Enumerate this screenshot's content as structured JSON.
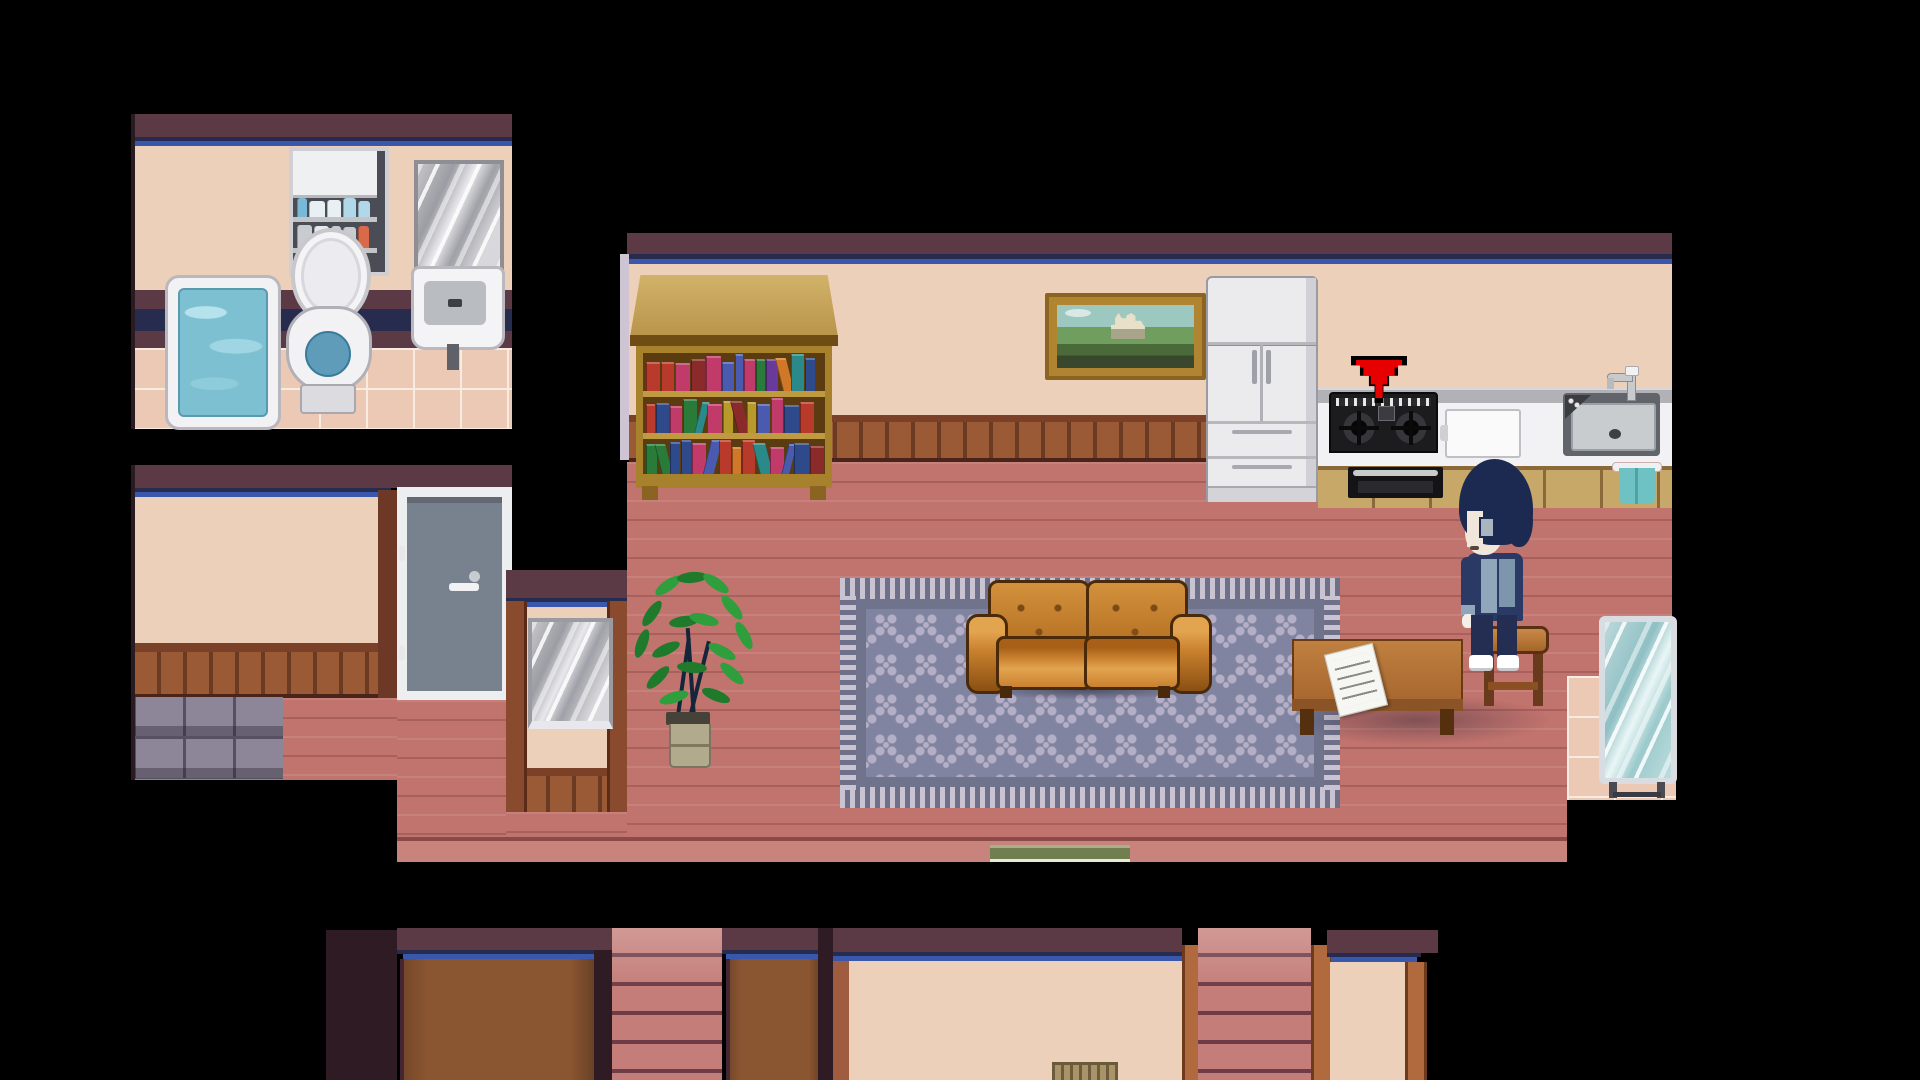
{
  "scene": {
    "title": "Top-down pixel RPG house interior (OMORI-style)",
    "screen": {
      "width": 1920,
      "height": 1080
    },
    "visible_text": []
  },
  "palette": {
    "band": "#5b3a46",
    "darkMaroon": "#2e1b24",
    "stripeNavy": "#272b4e",
    "stripeBlue": "#3a57ae",
    "trimLight": "#cfc4d4",
    "wall": "#ecd0ba",
    "wainscot": "#9a5a36",
    "wainscotGap": "#6b3a22",
    "wainscotRail": "#7a4028",
    "wainscotLine": "#4a2418",
    "floor": "#c1736d",
    "floorEdge": "#c8837c",
    "floorEdgeLine": "#8a4a48",
    "tileFloor": "#ecc9b5",
    "tileGrout": "#f8ece2",
    "grayTile": "#8d8698",
    "grayTileGrout": "#575061",
    "rugField": "#8184a0",
    "rugMotif": "#b4aec6",
    "rugBorder": "#70738c",
    "fringeLight": "#cac4d2",
    "fringeDark": "#6e7089",
    "couch": "#c9812f",
    "couchDark": "#8a5012",
    "couchLight": "#e3a44f",
    "couchOutline": "#4a2a08",
    "wood": "#c6a45e",
    "woodFrame": "#a8812c",
    "shelfBg": "#5a3c10",
    "applianceWhite": "#ebebed",
    "applianceShade": "#d0d0d6",
    "applianceOutline": "#9a9aa2",
    "counterTop": "#b2b2b6",
    "counterFront": "#f2f2f4",
    "cabinetTan": "#c8a869",
    "cabinetLine": "#8a6a3a",
    "stoveBlack": "#1c1c1e",
    "sinkSurround": "#62646c",
    "sinkBasin": "#c9ccce",
    "towel": "#6fc2c4",
    "arrowRed": "#e60000",
    "doorSlab": "#78818e",
    "doorFrame": "#eceef0",
    "waterBlue": "#7cc0d2",
    "toiletWater": "#5f9cba",
    "plantGreen": "#2f9e3c",
    "plantGreenDark": "#1f7a2c",
    "stem": "#16263a",
    "pot": "#b2aa8c",
    "hairNavy": "#1c2a52",
    "skin": "#f0e6da",
    "outfitNavy": "#2b3a64",
    "outfitLight": "#90a6ba",
    "pantsNavy": "#232e52",
    "mirrorGlass": "#a9cfd3",
    "mirrorFrame": "#d9dde2",
    "stairs": "#c47d78",
    "stairsLine": "#6e3c46",
    "panelBrown": "#8a5531",
    "panelEdge": "#432633",
    "postOrange": "#b06a3e",
    "matGreen": "#707e50",
    "matGreenLight": "#a8b088"
  },
  "rooms": {
    "bathroom": {
      "label": "bathroom",
      "fixtures": [
        "bathtub with water",
        "toilet with open lid",
        "medicine cabinet with bottles",
        "wall mirror",
        "wall sink"
      ]
    },
    "side_room": {
      "label": "side room",
      "fixtures": [
        "blank beige wall panel",
        "gray entry door with handle",
        "gray floor tiles"
      ]
    },
    "living_room": {
      "label": "living room and kitchen",
      "fixtures": [
        "bookshelf",
        "landscape painting",
        "refrigerator",
        "gas stove",
        "oven grill",
        "cutting board",
        "kitchen sink",
        "teal hand towel",
        "patterned rug",
        "leather couch",
        "coffee table",
        "paper note",
        "wooden stool",
        "potted plant",
        "standing mirror",
        "alcove mirror",
        "green doormat",
        "pink tile corner"
      ]
    },
    "lower_rooms": {
      "label": "lower floor rooms",
      "fixtures": [
        "brown panel wall",
        "staircase",
        "brown panel wall",
        "beige room",
        "staircase",
        "beige room"
      ]
    }
  },
  "indicator": {
    "name": "quest-arrow",
    "meaning": "interaction point above the stove",
    "color": "#e60000"
  },
  "character": {
    "name": "player-character",
    "description": "dark navy-haired boy in blue outfit standing by the coffee table",
    "hair_color": "#1c2a52",
    "outfit_colors": [
      "#2b3a64",
      "#90a6ba"
    ],
    "shoes": "white"
  },
  "objects": {
    "bookshelf": {
      "book_colors": [
        "#2e4a8a",
        "#b83a2a",
        "#6a3a9a",
        "#2a7a3a",
        "#d07828",
        "#c03a6a",
        "#2a8a8a",
        "#b89a2a",
        "#4a5aae",
        "#8a2a2a"
      ]
    },
    "cabinet": {
      "item_colors_top": [
        "#7ab8d8",
        "#e8f0f4",
        "#88c4dc",
        "#d0d4d8",
        "#b0d8e8"
      ],
      "item_colors_bottom": [
        "#d86a4a",
        "#e8e8ec",
        "#c8ccd0",
        "#88b4cc"
      ]
    },
    "paper_note": {
      "legible": false,
      "line_count": 5
    },
    "painting": {
      "subject": "white castle in green landscape"
    }
  }
}
